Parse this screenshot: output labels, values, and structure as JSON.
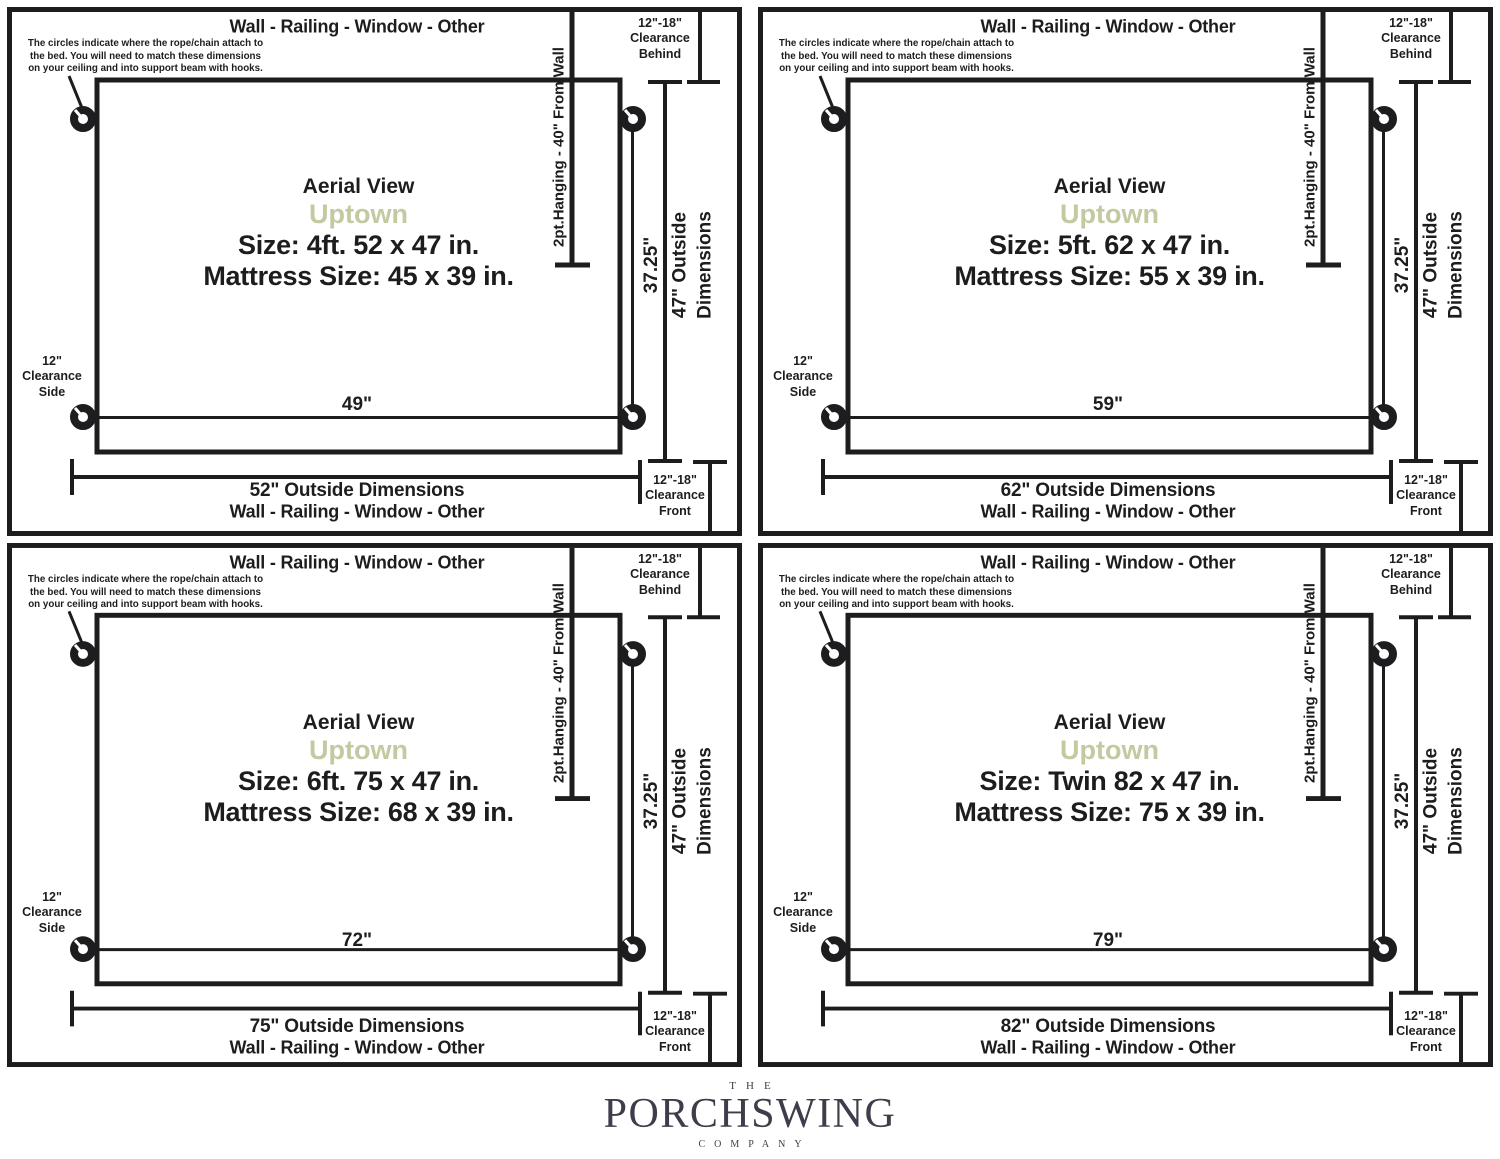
{
  "shared": {
    "wall_label": "Wall - Railing - Window - Other",
    "note_lines": [
      "The circles indicate where the rope/chain attach to",
      "the bed. You will need to match these dimensions",
      "on your ceiling and into support beam with hooks."
    ],
    "aerial_label": "Aerial View",
    "model_name": "Uptown",
    "hanging_label": "2pt.Hanging - 40\" From Wall",
    "inner_depth": "37.25\"",
    "outside_depth_lines": [
      "47\" Outside",
      "Dimensions"
    ],
    "clearance_behind_lines": [
      "12\"-18\"",
      "Clearance",
      "Behind"
    ],
    "clearance_side_lines": [
      "12\"",
      "Clearance",
      "Side"
    ],
    "clearance_front_lines": [
      "12\"-18\"",
      "Clearance",
      "Front"
    ],
    "colors": {
      "ink": "#1d1d1f",
      "accent": "#c4c9a1",
      "logo": "#3e3e4a"
    }
  },
  "panels": [
    {
      "size_label": "Size: 4ft. 52 x 47 in.",
      "mattress_label": "Mattress Size: 45 x 39 in.",
      "inner_width": "49\"",
      "outside_width": "52\" Outside Dimensions"
    },
    {
      "size_label": "Size: 5ft. 62 x 47 in.",
      "mattress_label": "Mattress Size: 55 x 39 in.",
      "inner_width": "59\"",
      "outside_width": "62\" Outside Dimensions"
    },
    {
      "size_label": "Size: 6ft. 75 x 47 in.",
      "mattress_label": "Mattress Size: 68 x 39 in.",
      "inner_width": "72\"",
      "outside_width": "75\" Outside Dimensions"
    },
    {
      "size_label": "Size: Twin 82 x 47 in.",
      "mattress_label": "Mattress Size: 75 x 39 in.",
      "inner_width": "79\"",
      "outside_width": "82\" Outside Dimensions"
    }
  ],
  "logo": {
    "top": "THE",
    "name": "PORCHSWING",
    "bottom": "COMPANY"
  }
}
